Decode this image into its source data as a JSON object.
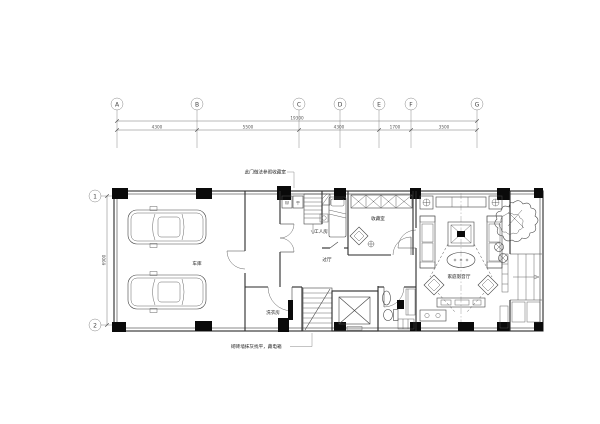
{
  "grid": {
    "top_labels": [
      "A",
      "B",
      "C",
      "D",
      "E",
      "F",
      "G"
    ],
    "left_labels": [
      "1",
      "2"
    ]
  },
  "dimensions": {
    "overall": "19300",
    "segments": [
      "4300",
      "5500",
      "4300",
      "1700",
      "3500"
    ],
    "left_height": "6900"
  },
  "rooms": {
    "garage": "车库",
    "worker_room": "工人房",
    "hallway": "过厅",
    "collection_room": "收藏室",
    "av_room": "家庭影音厅",
    "laundry": "洗衣房"
  },
  "appliances": {
    "washer": "W",
    "dryer": "干"
  },
  "annotations": {
    "door_note": "此门做法参照收藏室",
    "wall_note": "砌砖墙抹灰找平，藏电箱"
  }
}
